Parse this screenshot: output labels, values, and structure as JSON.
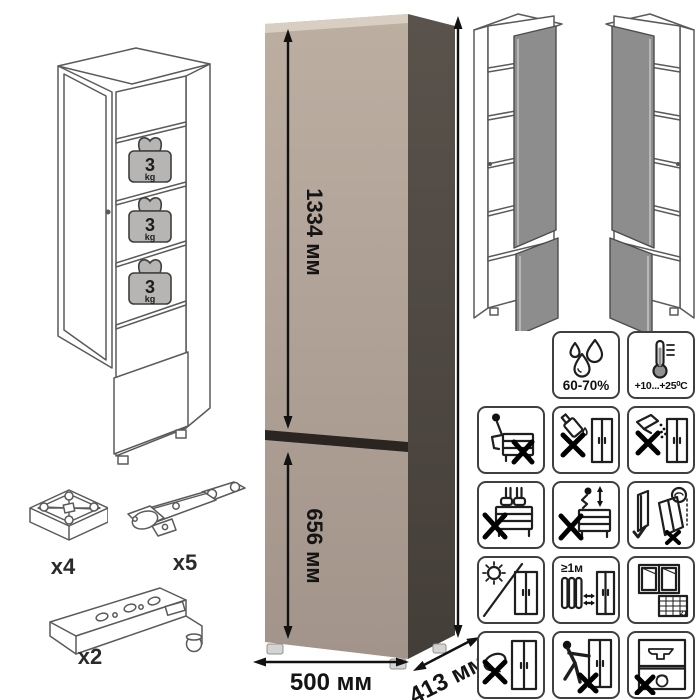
{
  "product": {
    "shelf_load": {
      "value": "3",
      "unit": "kg"
    },
    "dimensions": {
      "upper_door": "1334 мм",
      "lower_door": "656 мм",
      "height": "2052 мм",
      "width": "500 мм",
      "depth": "413 мм"
    }
  },
  "hardware": {
    "feet_qty": "x4",
    "hinges_qty": "x5",
    "rails_qty": "x2"
  },
  "climate": {
    "humidity": "60-70%",
    "temperature": "+10...+25⁰C"
  },
  "care": {
    "min_heat_distance": "≥1м",
    "calendar_day": "21"
  },
  "colors": {
    "cabinet_front": "#b3a497",
    "cabinet_side": "#4e4840",
    "cabinet_top_edge": "#d8cec2",
    "door_gap": "#2a2521",
    "wireframe_door_gray": "#8d8d8d",
    "weight_badge_gray": "#b7b5b3"
  },
  "icon_names": [
    "humidity-icon",
    "temperature-icon",
    "no-sitting-icon",
    "no-liquids-icon",
    "no-powder-spill-icon",
    "no-standing-icon",
    "no-jumping-icon",
    "tip-over-warning-icon",
    "no-direct-sunlight-icon",
    "heat-source-distance-icon",
    "room-ventilation-icon",
    "no-abrasive-cleaning-icon",
    "no-dragging-icon",
    "no-heavy-objects-icon",
    "shelf-weight-badge",
    "feet-icon",
    "hinge-icon",
    "plinth-rail-icon"
  ]
}
